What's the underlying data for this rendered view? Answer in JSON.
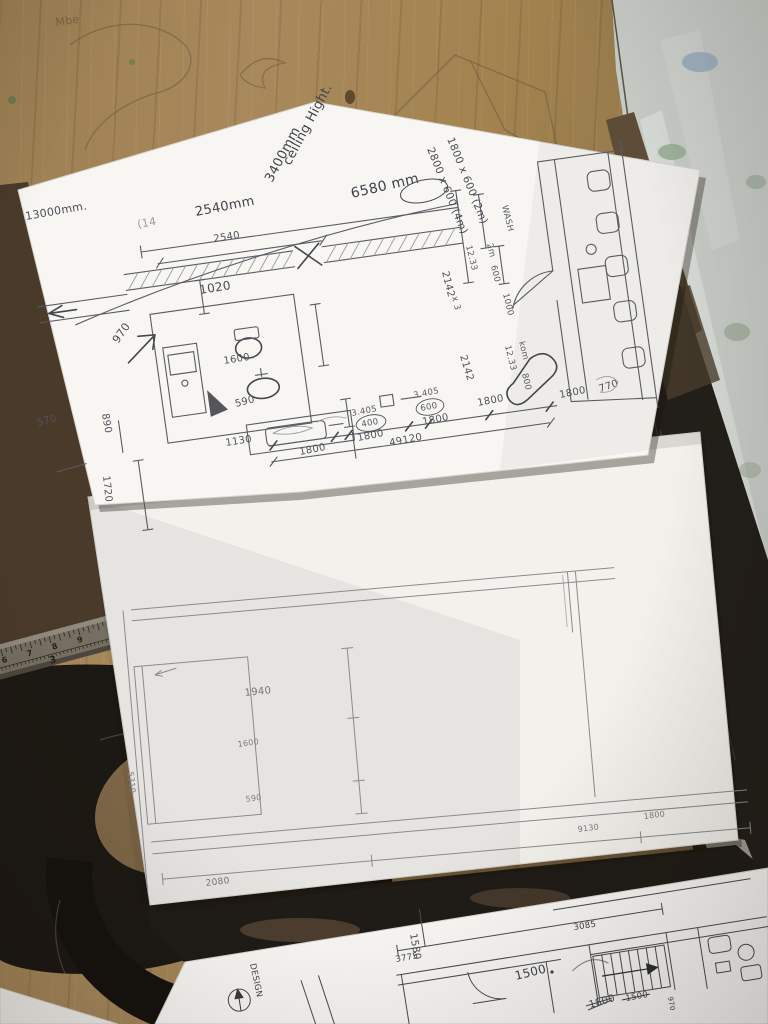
{
  "ruler": {
    "inch_numbers": [
      "6",
      "7",
      "8",
      "9",
      "1"
    ],
    "cm_number": "3"
  },
  "table": {
    "graffiti": "Mbe"
  },
  "top_sheet": {
    "notes": {
      "overall_width": "13000mm.",
      "span": "2540mm",
      "faint_mark": "(14",
      "ceiling_line1": "ceiling Hight.",
      "ceiling_line2": "3400mm",
      "length_label": "6580 mm",
      "shelf_2m": "1800 x 600 (2m)",
      "shelf_4m": "2800 x 600 (4m)",
      "wash": "WASH",
      "room_word": "kom"
    },
    "dims": {
      "top_span": "2540",
      "wall": "1020",
      "d970": "970",
      "d890": "890",
      "d1600": "1600",
      "d590": "590",
      "d1130": "1130",
      "d1720": "1720",
      "d570": "570",
      "d2142_upper": "2142",
      "x3": "x 3",
      "area_upper": "12.33",
      "col_2m": "2m",
      "col_600": "600",
      "col_1000": "1000",
      "d2142_lower": "2142",
      "area_lower": "12.33",
      "d800": "800",
      "right_1800": "1800",
      "right_770": "770",
      "chain": {
        "seg1": "1800",
        "note1": "3.405",
        "c400": "400",
        "seg2": "1800",
        "note2": "3.405",
        "c600": "600",
        "seg3": "1800",
        "seg4": "1800",
        "total": "49120"
      }
    }
  },
  "middle_sheet": {
    "dims": {
      "d1940": "1940",
      "d1600": "1600",
      "d590": "590",
      "d5310": "5310",
      "d2080": "2080",
      "d9130": "9130",
      "d1800": "1800"
    }
  },
  "bottom_sheet": {
    "title_block": "DESIGN",
    "dims": {
      "d3775": "3775",
      "d3085": "3085",
      "d1580": "1580",
      "hand_1500": "1500",
      "printed_1500": "1500",
      "hand_1800": "1800",
      "d970": "970"
    }
  }
}
